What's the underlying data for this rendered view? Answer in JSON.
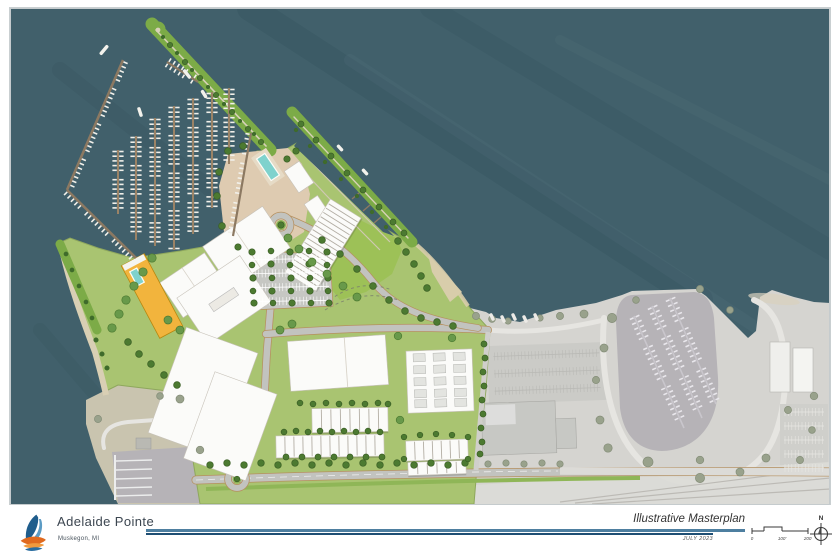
{
  "document": {
    "type": "illustrative-site-masterplan-sheet",
    "project_name": "Adelaide Pointe",
    "project_location": "Muskegon, MI",
    "drawing_title": "Illustrative Masterplan",
    "drawing_date": "JULY 2023",
    "north_label": "N",
    "scale_labels": [
      "0",
      "100'",
      "200'"
    ]
  },
  "colors": {
    "water": "#41606b",
    "lawn": "#a9c471",
    "lawn_bright": "#9dc157",
    "strip_green": "#7cab47",
    "tree_dark": "#4c7a31",
    "tree_light": "#68994a",
    "context_tree": "#99a28c",
    "plaza": "#decbb1",
    "sand": "#d8cdab",
    "building": "#fbfbf9",
    "building_stroke": "#c7c2b9",
    "yellow_bldg": "#f2b43d",
    "pool": "#7fd2cd",
    "dock": "#8c7962",
    "boat": "#f1f0ea",
    "road": "#c2c3bf",
    "road_edge": "#b6905f",
    "path_tan": "#d8d1b8",
    "context_land": "#d5d4d0",
    "context_basin": "#b6b3b7",
    "context_road": "#e6e5e1",
    "accent_rule": "#4e7fa0",
    "accent_rule2": "#1f4f74",
    "logo_blue": "#1f5d8c",
    "logo_light_blue": "#5b9bc4",
    "logo_orange": "#e06a1f",
    "text_dark": "#3c4650"
  }
}
